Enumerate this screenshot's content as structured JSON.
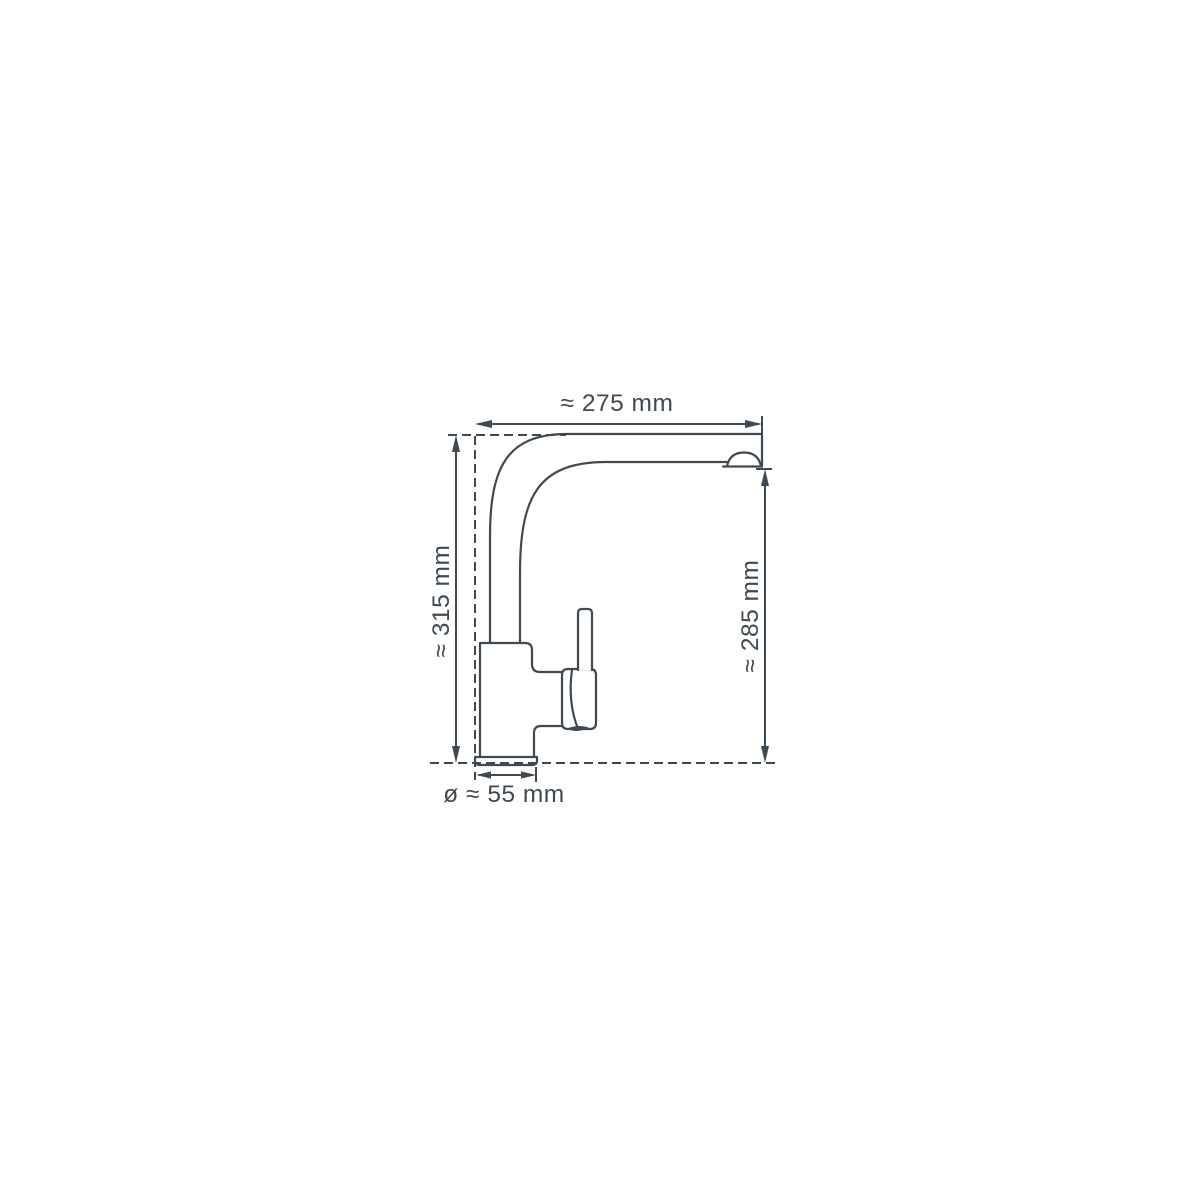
{
  "diagram": {
    "type": "technical dimension drawing",
    "subject": "single-lever kitchen mixer tap, side view",
    "background_color": "#ffffff",
    "line_color": "#3e4951",
    "labels": {
      "top_width": "≈ 275 mm",
      "left_total_height": "≈ 315 mm",
      "right_spout_height": "≈ 285 mm",
      "bottom_base_diameter": "ø ≈ 55 mm"
    },
    "measurements": {
      "top_width_mm": 275,
      "left_total_height_mm": 315,
      "right_spout_height_mm": 285,
      "bottom_base_diameter_mm": 55,
      "unit": "mm",
      "approximate_symbol": "≈",
      "diameter_symbol": "ø"
    }
  }
}
